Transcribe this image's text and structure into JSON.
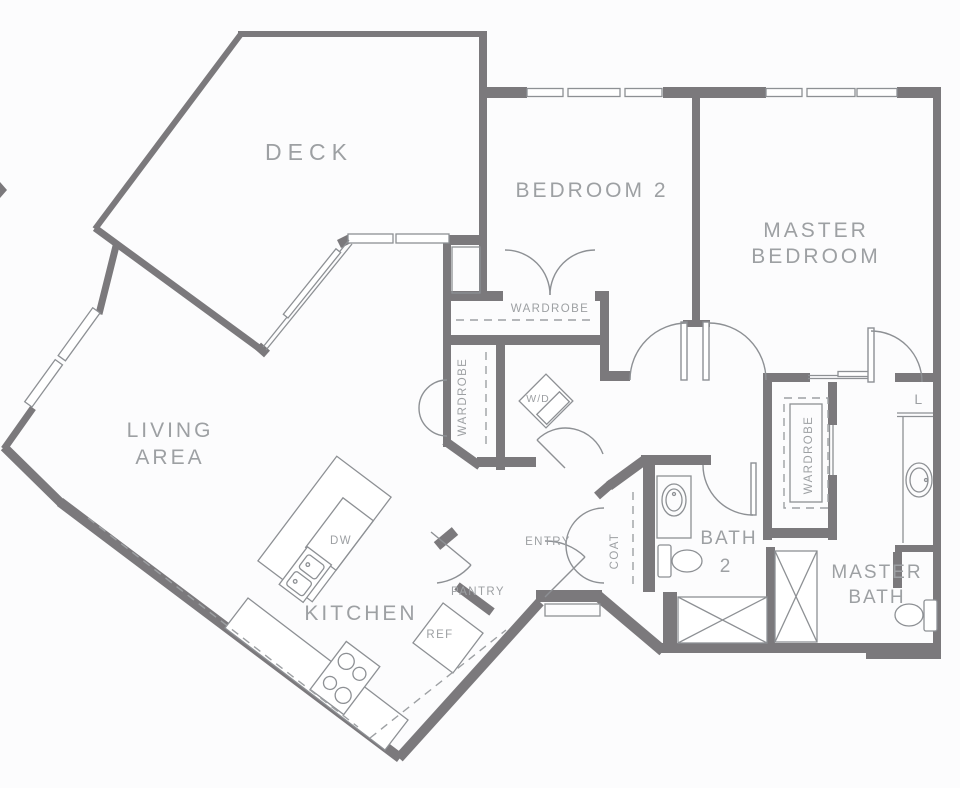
{
  "colors": {
    "background": "#fcfcfd",
    "walls": "#7b797c",
    "thin_lines": "#8d9094",
    "text": "#9da0a3"
  },
  "labels": {
    "deck": "DECK",
    "bedroom2": "BEDROOM 2",
    "master_bedroom_line1": "MASTER",
    "master_bedroom_line2": "BEDROOM",
    "living_line1": "LIVING",
    "living_line2": "AREA",
    "kitchen": "KITCHEN",
    "wardrobe_bedroom2": "WARDROBE",
    "wardrobe_hall": "WARDROBE",
    "wardrobe_master": "WARDROBE",
    "washer_dryer": "W/D",
    "entry": "ENTRY",
    "coat": "COAT",
    "pantry": "PANTRY",
    "dishwasher": "DW",
    "refrigerator": "REF",
    "bath2_line1": "BATH",
    "bath2_line2": "2",
    "master_bath_line1": "MASTER",
    "master_bath_line2": "BATH",
    "linen_closet": "L"
  }
}
